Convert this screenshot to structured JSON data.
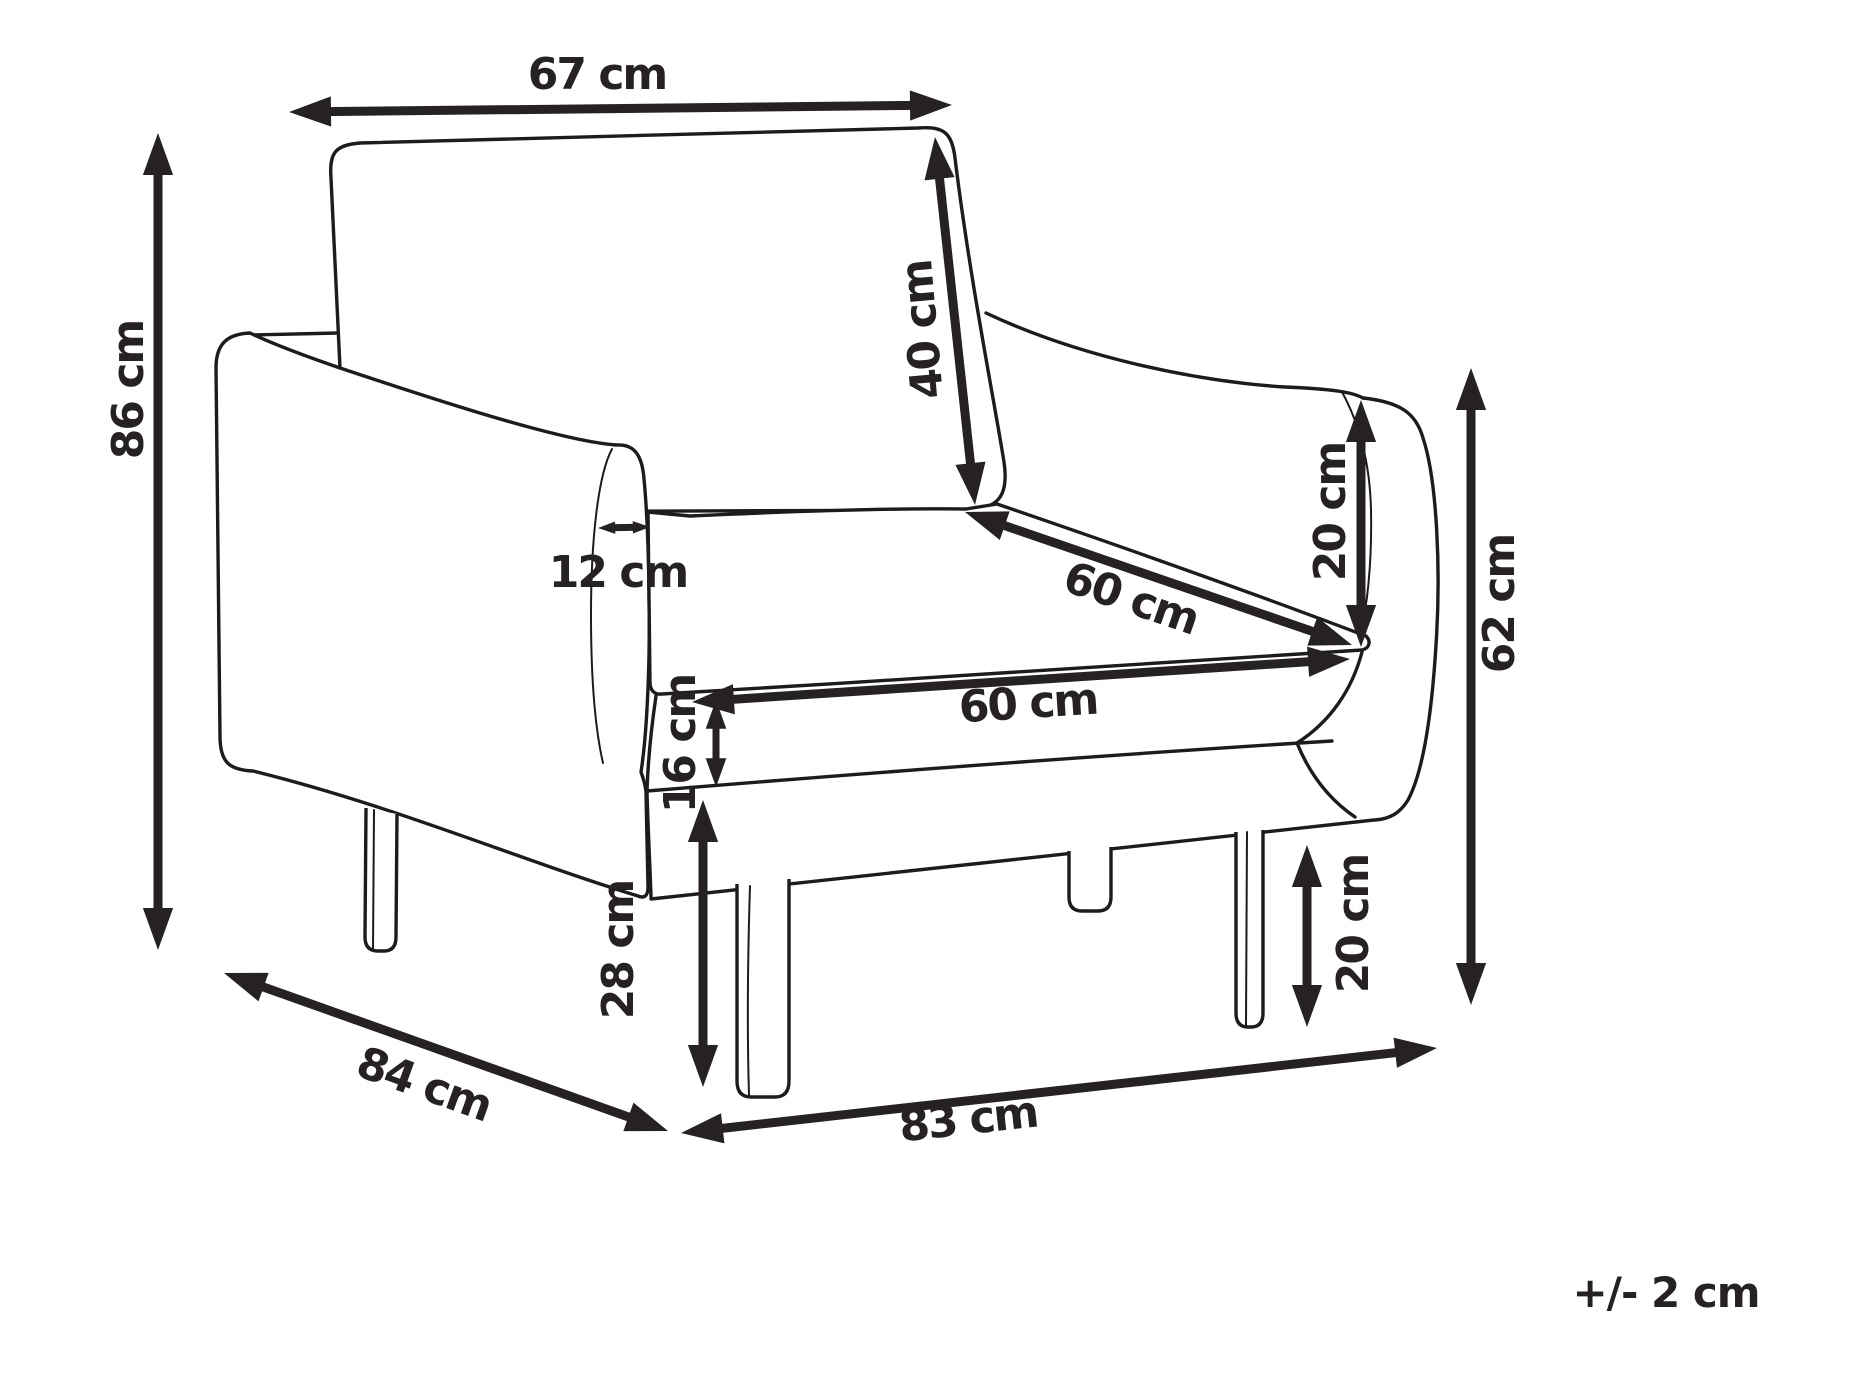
{
  "diagram": {
    "type": "furniture-dimension-diagram",
    "subject": "armchair",
    "unit": "cm",
    "tolerance_note": "+/- 2 cm",
    "style": {
      "background": "#ffffff",
      "line_color": "#1d1b1b",
      "text_color": "#262223"
    },
    "dimensions": [
      {
        "id": "top-width",
        "label": "67 cm",
        "meaning": "backrest cushion width"
      },
      {
        "id": "total-height",
        "label": "86 cm",
        "meaning": "total height"
      },
      {
        "id": "backrest-height",
        "label": "40 cm",
        "meaning": "backrest cushion height"
      },
      {
        "id": "armrest-width",
        "label": "12 cm",
        "meaning": "armrest width"
      },
      {
        "id": "seat-depth",
        "label": "60 cm",
        "meaning": "seat depth"
      },
      {
        "id": "armrest-above-seat",
        "label": "20 cm",
        "meaning": "armrest height above seat"
      },
      {
        "id": "seat-width",
        "label": "60 cm",
        "meaning": "seat width"
      },
      {
        "id": "seat-cushion-thickness",
        "label": "16 cm",
        "meaning": "seat cushion thickness"
      },
      {
        "id": "seat-height",
        "label": "28 cm",
        "meaning": "floor to seat frame"
      },
      {
        "id": "arm-height",
        "label": "62 cm",
        "meaning": "floor to armrest top"
      },
      {
        "id": "leg-height",
        "label": "20 cm",
        "meaning": "leg height"
      },
      {
        "id": "total-depth",
        "label": "84 cm",
        "meaning": "total depth"
      },
      {
        "id": "total-width",
        "label": "83 cm",
        "meaning": "total width"
      }
    ]
  }
}
